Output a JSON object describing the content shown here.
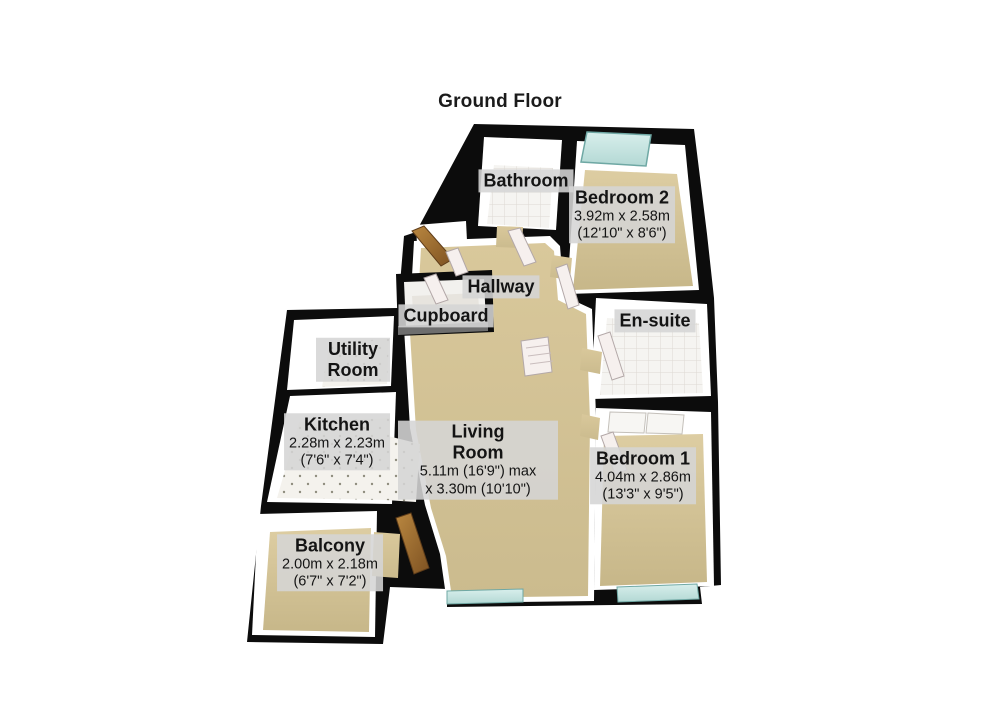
{
  "title": "Ground Floor",
  "rooms": {
    "bathroom": {
      "name": "Bathroom"
    },
    "bedroom2": {
      "name": "Bedroom 2",
      "dims_metric": "3.92m x 2.58m",
      "dims_imperial": "(12'10\" x 8'6\")"
    },
    "hallway": {
      "name": "Hallway"
    },
    "cupboard": {
      "name": "Cupboard"
    },
    "ensuite": {
      "name": "En-suite"
    },
    "utility": {
      "name": "Utility Room"
    },
    "kitchen": {
      "name": "Kitchen",
      "dims_metric": "2.28m x 2.23m",
      "dims_imperial": "(7'6\" x 7'4\")"
    },
    "living": {
      "name": "Living Room",
      "dims_metric": "5.11m (16'9\") max",
      "dims_imperial": "x 3.30m (10'10\")"
    },
    "bedroom1": {
      "name": "Bedroom 1",
      "dims_metric": "4.04m x 2.86m",
      "dims_imperial": "(13'3\" x 9'5\")"
    },
    "balcony": {
      "name": "Balcony",
      "dims_metric": "2.00m x 2.18m",
      "dims_imperial": "(6'7\" x 7'2\")"
    }
  },
  "colors": {
    "wall": "#0c0c0c",
    "carpet": "#d5c496",
    "tile": "#f4f3f0",
    "window": "#c6e4e0",
    "door_wood": "#a9743d",
    "label_bg": "#d5d5d5",
    "text": "#141414"
  }
}
